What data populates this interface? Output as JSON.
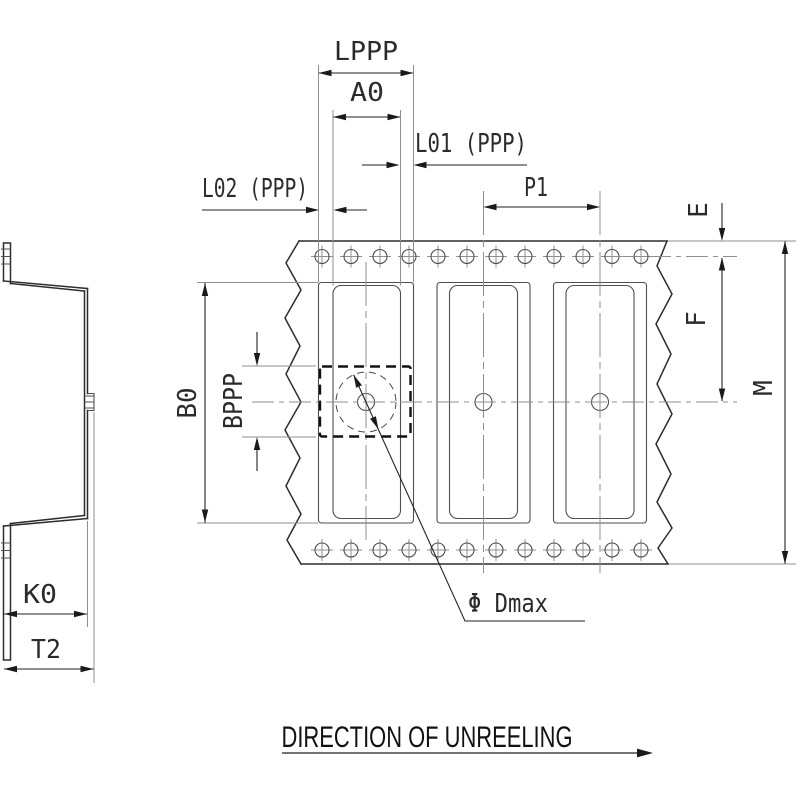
{
  "drawing": {
    "caption": {
      "text": "DIRECTION OF UNREELING"
    },
    "dimension_labels": {
      "lppp": "LPPP",
      "a0": "A0",
      "l01": "L01 (PPP)",
      "l02": "L02 (PPP)",
      "p1": "P1",
      "e": "E",
      "f": "F",
      "m": "M",
      "b0": "B0",
      "bppp": "BPPP",
      "k0": "K0",
      "t2": "T2",
      "dmax": "Φ Dmax"
    },
    "plan_view": {
      "pockets_visible": 3,
      "sprocket_holes_per_row": 12,
      "sprocket_hole_rows": 2
    },
    "colors": {
      "ink": "#2d2d2d",
      "paper": "#ffffff"
    }
  }
}
